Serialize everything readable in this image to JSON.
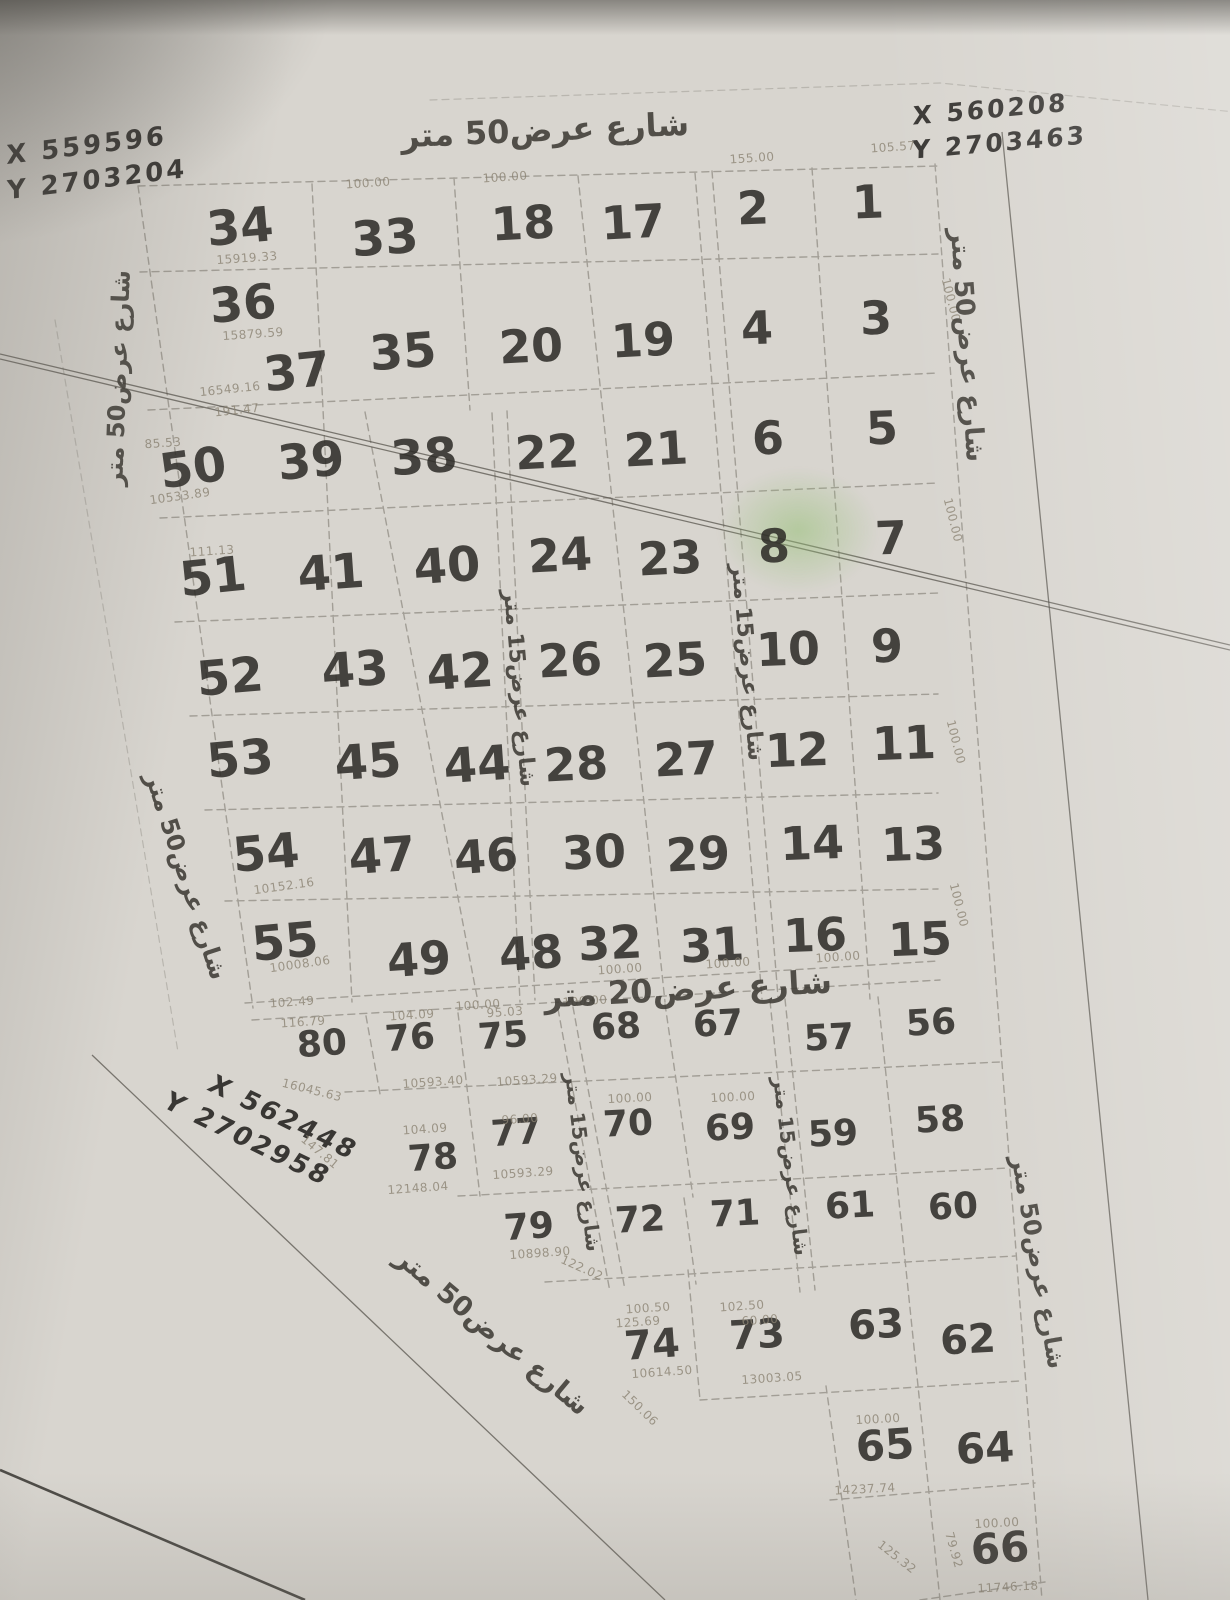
{
  "page": {
    "background": "#d8d5cf",
    "ink": "#2b2925",
    "pencil_gray": "#6b675e",
    "dim_gray": "#8b8373",
    "highlight_green": "#96c076"
  },
  "annotations": {
    "top_left": {
      "line1": "X 559596",
      "line2": "Y 2703204"
    },
    "top_right": {
      "line1": "X 560208",
      "line2": "Y 2703463"
    },
    "bottom_left": {
      "line1": "X 562448",
      "line2": "Y 2702958"
    }
  },
  "streets": [
    {
      "t": "شارع عرض50 متر",
      "x": 545,
      "y": 130,
      "r": -2.5,
      "s": 32
    },
    {
      "t": "شارع عرض50 متر",
      "x": 967,
      "y": 345,
      "r": 86,
      "s": 26
    },
    {
      "t": "شارع عرض50 متر",
      "x": 118,
      "y": 378,
      "r": -88,
      "s": 24
    },
    {
      "t": "شارع عرض50 متر",
      "x": 186,
      "y": 876,
      "r": 72,
      "s": 24
    },
    {
      "t": "شارع عرض15 متر",
      "x": 519,
      "y": 688,
      "r": 85,
      "s": 22
    },
    {
      "t": "شارع عرض15 متر",
      "x": 747,
      "y": 662,
      "r": 85,
      "s": 22
    },
    {
      "t": "شارع عرض20 متر",
      "x": 688,
      "y": 989,
      "r": -3,
      "s": 32
    },
    {
      "t": "شارع عرض15 متر",
      "x": 583,
      "y": 1162,
      "r": 83,
      "s": 20
    },
    {
      "t": "شارع عرض15 متر",
      "x": 791,
      "y": 1166,
      "r": 83,
      "s": 20
    },
    {
      "t": "شارع عرض50 متر",
      "x": 492,
      "y": 1332,
      "r": 40,
      "s": 27
    },
    {
      "t": "شارع عرض50 متر",
      "x": 1038,
      "y": 1262,
      "r": 80,
      "s": 24
    }
  ],
  "plots": [
    {
      "n": "34",
      "x": 240,
      "y": 227,
      "s": 48,
      "r": -5
    },
    {
      "n": "33",
      "x": 385,
      "y": 238,
      "s": 48,
      "r": -4
    },
    {
      "n": "18",
      "x": 523,
      "y": 223,
      "s": 46,
      "r": -3
    },
    {
      "n": "17",
      "x": 633,
      "y": 222,
      "s": 46,
      "r": -3
    },
    {
      "n": "2",
      "x": 753,
      "y": 208,
      "s": 46,
      "r": -2
    },
    {
      "n": "1",
      "x": 868,
      "y": 202,
      "s": 46,
      "r": -2
    },
    {
      "n": "36",
      "x": 243,
      "y": 304,
      "s": 48,
      "r": -5
    },
    {
      "n": "37",
      "x": 297,
      "y": 372,
      "s": 48,
      "r": -6
    },
    {
      "n": "35",
      "x": 403,
      "y": 352,
      "s": 48,
      "r": -4
    },
    {
      "n": "20",
      "x": 531,
      "y": 346,
      "s": 46,
      "r": -3
    },
    {
      "n": "19",
      "x": 643,
      "y": 340,
      "s": 46,
      "r": -3
    },
    {
      "n": "4",
      "x": 757,
      "y": 328,
      "s": 46,
      "r": -2
    },
    {
      "n": "3",
      "x": 876,
      "y": 318,
      "s": 46,
      "r": -2
    },
    {
      "n": "50",
      "x": 193,
      "y": 468,
      "s": 48,
      "r": -8
    },
    {
      "n": "39",
      "x": 311,
      "y": 461,
      "s": 48,
      "r": -5
    },
    {
      "n": "38",
      "x": 424,
      "y": 457,
      "s": 48,
      "r": -4
    },
    {
      "n": "22",
      "x": 547,
      "y": 452,
      "s": 46,
      "r": -3
    },
    {
      "n": "21",
      "x": 656,
      "y": 449,
      "s": 46,
      "r": -3
    },
    {
      "n": "6",
      "x": 768,
      "y": 438,
      "s": 46,
      "r": -2
    },
    {
      "n": "5",
      "x": 882,
      "y": 428,
      "s": 46,
      "r": -2
    },
    {
      "n": "51",
      "x": 213,
      "y": 577,
      "s": 48,
      "r": -6
    },
    {
      "n": "41",
      "x": 331,
      "y": 573,
      "s": 48,
      "r": -4
    },
    {
      "n": "40",
      "x": 447,
      "y": 566,
      "s": 48,
      "r": -4
    },
    {
      "n": "24",
      "x": 560,
      "y": 555,
      "s": 46,
      "r": -3
    },
    {
      "n": "23",
      "x": 670,
      "y": 558,
      "s": 46,
      "r": -3
    },
    {
      "n": "8",
      "x": 774,
      "y": 546,
      "s": 46,
      "r": -2
    },
    {
      "n": "7",
      "x": 891,
      "y": 538,
      "s": 46,
      "r": -2
    },
    {
      "n": "52",
      "x": 230,
      "y": 677,
      "s": 48,
      "r": -5
    },
    {
      "n": "43",
      "x": 355,
      "y": 670,
      "s": 48,
      "r": -4
    },
    {
      "n": "42",
      "x": 460,
      "y": 672,
      "s": 48,
      "r": -4
    },
    {
      "n": "26",
      "x": 570,
      "y": 660,
      "s": 46,
      "r": -3
    },
    {
      "n": "25",
      "x": 675,
      "y": 660,
      "s": 46,
      "r": -3
    },
    {
      "n": "10",
      "x": 788,
      "y": 649,
      "s": 46,
      "r": -2
    },
    {
      "n": "9",
      "x": 887,
      "y": 646,
      "s": 46,
      "r": -2
    },
    {
      "n": "53",
      "x": 240,
      "y": 759,
      "s": 48,
      "r": -5
    },
    {
      "n": "45",
      "x": 368,
      "y": 762,
      "s": 48,
      "r": -4
    },
    {
      "n": "44",
      "x": 477,
      "y": 765,
      "s": 48,
      "r": -4
    },
    {
      "n": "28",
      "x": 576,
      "y": 764,
      "s": 46,
      "r": -3
    },
    {
      "n": "27",
      "x": 686,
      "y": 759,
      "s": 46,
      "r": -3
    },
    {
      "n": "12",
      "x": 797,
      "y": 750,
      "s": 46,
      "r": -2
    },
    {
      "n": "11",
      "x": 904,
      "y": 743,
      "s": 46,
      "r": -2
    },
    {
      "n": "54",
      "x": 266,
      "y": 853,
      "s": 48,
      "r": -5
    },
    {
      "n": "47",
      "x": 382,
      "y": 856,
      "s": 48,
      "r": -4
    },
    {
      "n": "46",
      "x": 486,
      "y": 856,
      "s": 46,
      "r": -4
    },
    {
      "n": "30",
      "x": 594,
      "y": 852,
      "s": 46,
      "r": -3
    },
    {
      "n": "29",
      "x": 698,
      "y": 854,
      "s": 46,
      "r": -3
    },
    {
      "n": "14",
      "x": 812,
      "y": 843,
      "s": 46,
      "r": -2
    },
    {
      "n": "13",
      "x": 913,
      "y": 844,
      "s": 46,
      "r": -2
    },
    {
      "n": "55",
      "x": 285,
      "y": 942,
      "s": 48,
      "r": -5
    },
    {
      "n": "49",
      "x": 419,
      "y": 959,
      "s": 46,
      "r": -4
    },
    {
      "n": "48",
      "x": 531,
      "y": 953,
      "s": 46,
      "r": -4
    },
    {
      "n": "32",
      "x": 610,
      "y": 943,
      "s": 46,
      "r": -3
    },
    {
      "n": "31",
      "x": 712,
      "y": 945,
      "s": 46,
      "r": -3
    },
    {
      "n": "16",
      "x": 815,
      "y": 935,
      "s": 46,
      "r": -2
    },
    {
      "n": "15",
      "x": 920,
      "y": 939,
      "s": 46,
      "r": -2
    },
    {
      "n": "80",
      "x": 322,
      "y": 1044,
      "s": 36,
      "r": -4
    },
    {
      "n": "76",
      "x": 410,
      "y": 1038,
      "s": 36,
      "r": -4
    },
    {
      "n": "75",
      "x": 503,
      "y": 1036,
      "s": 36,
      "r": -4
    },
    {
      "n": "68",
      "x": 616,
      "y": 1027,
      "s": 36,
      "r": -3
    },
    {
      "n": "67",
      "x": 718,
      "y": 1024,
      "s": 36,
      "r": -3
    },
    {
      "n": "57",
      "x": 829,
      "y": 1038,
      "s": 36,
      "r": -3
    },
    {
      "n": "56",
      "x": 931,
      "y": 1023,
      "s": 36,
      "r": -3
    },
    {
      "n": "78",
      "x": 433,
      "y": 1158,
      "s": 36,
      "r": -4
    },
    {
      "n": "77",
      "x": 516,
      "y": 1133,
      "s": 36,
      "r": -4
    },
    {
      "n": "70",
      "x": 628,
      "y": 1124,
      "s": 36,
      "r": -3
    },
    {
      "n": "69",
      "x": 730,
      "y": 1128,
      "s": 36,
      "r": -3
    },
    {
      "n": "59",
      "x": 833,
      "y": 1134,
      "s": 36,
      "r": -3
    },
    {
      "n": "58",
      "x": 940,
      "y": 1120,
      "s": 36,
      "r": -3
    },
    {
      "n": "79",
      "x": 529,
      "y": 1227,
      "s": 36,
      "r": -4
    },
    {
      "n": "72",
      "x": 640,
      "y": 1220,
      "s": 36,
      "r": -3
    },
    {
      "n": "71",
      "x": 735,
      "y": 1214,
      "s": 36,
      "r": -3
    },
    {
      "n": "61",
      "x": 850,
      "y": 1206,
      "s": 36,
      "r": -3
    },
    {
      "n": "60",
      "x": 953,
      "y": 1207,
      "s": 36,
      "r": -3
    },
    {
      "n": "74",
      "x": 652,
      "y": 1345,
      "s": 40,
      "r": -4
    },
    {
      "n": "73",
      "x": 757,
      "y": 1335,
      "s": 40,
      "r": -3
    },
    {
      "n": "63",
      "x": 876,
      "y": 1325,
      "s": 40,
      "r": -3
    },
    {
      "n": "62",
      "x": 968,
      "y": 1340,
      "s": 40,
      "r": -3
    },
    {
      "n": "65",
      "x": 885,
      "y": 1445,
      "s": 42,
      "r": -4
    },
    {
      "n": "64",
      "x": 985,
      "y": 1448,
      "s": 42,
      "r": -3
    },
    {
      "n": "66",
      "x": 1000,
      "y": 1548,
      "s": 42,
      "r": -4
    }
  ],
  "dimensions": [
    {
      "t": "105.57",
      "x": 893,
      "y": 147,
      "r": -4
    },
    {
      "t": "155.00",
      "x": 752,
      "y": 158,
      "r": -4
    },
    {
      "t": "100.00",
      "x": 368,
      "y": 183,
      "r": -4
    },
    {
      "t": "100.00",
      "x": 505,
      "y": 177,
      "r": -4
    },
    {
      "t": "15919.33",
      "x": 247,
      "y": 258,
      "r": -4
    },
    {
      "t": "15879.59",
      "x": 253,
      "y": 334,
      "r": -4
    },
    {
      "t": "16549.16",
      "x": 230,
      "y": 389,
      "r": -6
    },
    {
      "t": "191.47",
      "x": 237,
      "y": 410,
      "r": -6
    },
    {
      "t": "85.53",
      "x": 163,
      "y": 443,
      "r": -4
    },
    {
      "t": "10533.89",
      "x": 180,
      "y": 496,
      "r": -8
    },
    {
      "t": "111.13",
      "x": 212,
      "y": 551,
      "r": -4
    },
    {
      "t": "10152.16",
      "x": 284,
      "y": 886,
      "r": -8
    },
    {
      "t": "10008.06",
      "x": 300,
      "y": 964,
      "r": -8
    },
    {
      "t": "102.49",
      "x": 292,
      "y": 1002,
      "r": -4
    },
    {
      "t": "100.00",
      "x": 478,
      "y": 1005,
      "r": -4
    },
    {
      "t": "100.00",
      "x": 585,
      "y": 1001,
      "r": -4
    },
    {
      "t": "100.00",
      "x": 620,
      "y": 969,
      "r": -4
    },
    {
      "t": "100.00",
      "x": 728,
      "y": 963,
      "r": -4
    },
    {
      "t": "100.00",
      "x": 838,
      "y": 957,
      "r": -4
    },
    {
      "t": "116.79",
      "x": 303,
      "y": 1022,
      "r": -4
    },
    {
      "t": "104.09",
      "x": 412,
      "y": 1015,
      "r": -4
    },
    {
      "t": "95.03",
      "x": 505,
      "y": 1012,
      "r": -4
    },
    {
      "t": "16045.63",
      "x": 312,
      "y": 1090,
      "r": 14
    },
    {
      "t": "10593.40",
      "x": 433,
      "y": 1082,
      "r": -4
    },
    {
      "t": "10593.29",
      "x": 527,
      "y": 1080,
      "r": -4
    },
    {
      "t": "100.00",
      "x": 630,
      "y": 1098,
      "r": -3
    },
    {
      "t": "100.00",
      "x": 733,
      "y": 1097,
      "r": -3
    },
    {
      "t": "104.09",
      "x": 425,
      "y": 1129,
      "r": -4
    },
    {
      "t": "96.00",
      "x": 520,
      "y": 1119,
      "r": -4
    },
    {
      "t": "10593.29",
      "x": 523,
      "y": 1173,
      "r": -4
    },
    {
      "t": "12148.04",
      "x": 418,
      "y": 1188,
      "r": -4
    },
    {
      "t": "147.81",
      "x": 320,
      "y": 1152,
      "r": 40
    },
    {
      "t": "10898.90",
      "x": 540,
      "y": 1253,
      "r": -4
    },
    {
      "t": "122.02",
      "x": 582,
      "y": 1268,
      "r": 24
    },
    {
      "t": "100.50",
      "x": 648,
      "y": 1308,
      "r": -4
    },
    {
      "t": "125.69",
      "x": 638,
      "y": 1322,
      "r": -4
    },
    {
      "t": "102.50",
      "x": 742,
      "y": 1306,
      "r": -4
    },
    {
      "t": "60.00",
      "x": 760,
      "y": 1320,
      "r": -4
    },
    {
      "t": "10614.50",
      "x": 662,
      "y": 1372,
      "r": -4
    },
    {
      "t": "13003.05",
      "x": 772,
      "y": 1378,
      "r": -4
    },
    {
      "t": "150.06",
      "x": 640,
      "y": 1408,
      "r": 44
    },
    {
      "t": "100.00",
      "x": 878,
      "y": 1419,
      "r": -3
    },
    {
      "t": "14237.74",
      "x": 865,
      "y": 1489,
      "r": -3
    },
    {
      "t": "125.32",
      "x": 897,
      "y": 1557,
      "r": 38
    },
    {
      "t": "79.92",
      "x": 954,
      "y": 1550,
      "r": 74
    },
    {
      "t": "100.00",
      "x": 997,
      "y": 1523,
      "r": -3
    },
    {
      "t": "11746.18",
      "x": 1008,
      "y": 1587,
      "r": -3
    },
    {
      "t": "100.00",
      "x": 951,
      "y": 300,
      "r": 76
    },
    {
      "t": "100.00",
      "x": 953,
      "y": 520,
      "r": 76
    },
    {
      "t": "100.00",
      "x": 956,
      "y": 742,
      "r": 76
    },
    {
      "t": "100.00",
      "x": 959,
      "y": 905,
      "r": 76
    }
  ]
}
